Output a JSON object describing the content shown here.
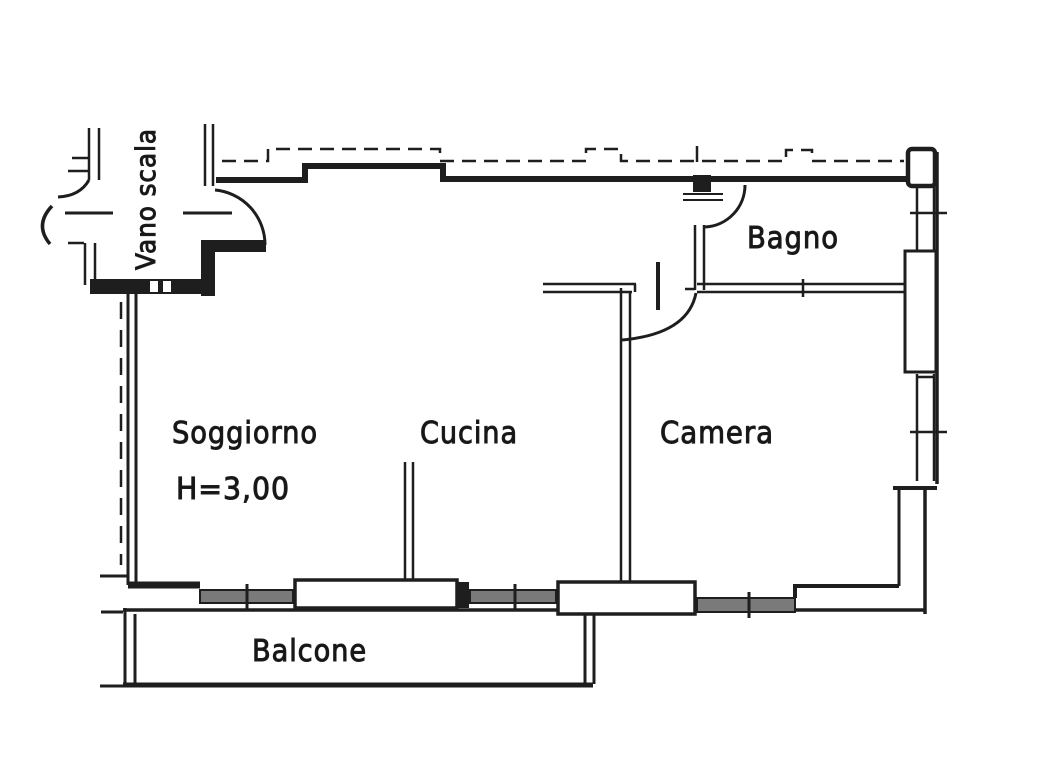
{
  "plan": {
    "labels": {
      "stairwell": "Vano scala",
      "bathroom": "Bagno",
      "living_room": "Soggiorno",
      "living_room_height": "H=3,00",
      "kitchen": "Cucina",
      "bedroom": "Camera",
      "balcony": "Balcone"
    },
    "colors": {
      "ink": "#1e1e1e",
      "paper": "#ffffff",
      "window_fill": "#7a7a7a"
    }
  }
}
